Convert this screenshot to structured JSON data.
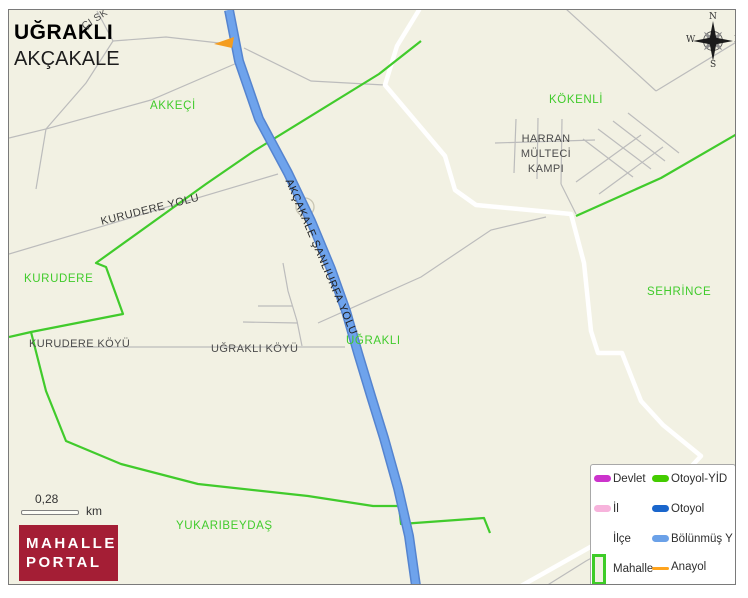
{
  "title": {
    "neighborhood": "UĞRAKLI",
    "district": "AKÇAKALE"
  },
  "map": {
    "region_labels": {
      "akkeci": "AKKEÇİ",
      "kokenli": "KÖKENLİ",
      "kurudere": "KURUDERE",
      "sehrince": "SEHRİNCE",
      "ugrakli": "UĞRAKLI",
      "yukaribeydas": "YUKARIBEYDAŞ"
    },
    "place_labels": {
      "harran_line1": "HARRAN",
      "harran_line2": "MÜLTECİ",
      "harran_line3": "KAMPI",
      "kurudere_koyu": "KURUDERE KÖYÜ",
      "ugrakli_koyu": "UĞRAKLI KÖYÜ"
    },
    "road_labels": {
      "kurudere_yolu": "KURUDERE YOLU",
      "akcakale_sanliurfa_yolu": "AKÇAKALE ŞANLIURFA YOLU",
      "sk": "ÇI SK"
    }
  },
  "compass": {
    "north": "N",
    "east": "E",
    "south": "S",
    "west": "W"
  },
  "scale_bar": {
    "distance": "0,28",
    "unit": "km"
  },
  "logo": {
    "line1": "MAHALLE",
    "line2": "PORTAL"
  },
  "legend": {
    "left": [
      {
        "label": "Devlet",
        "color": "#cc33cc"
      },
      {
        "label": "İl",
        "color": "#f7b3dc"
      },
      {
        "label": "İlçe",
        "color": "#ffffff"
      },
      {
        "label": "Mahalle",
        "color": "#3ecc28"
      }
    ],
    "right": [
      {
        "label": "Otoyol-YİD",
        "color": "#44cc00"
      },
      {
        "label": "Otoyol",
        "color": "#1a66cc"
      },
      {
        "label": "Bölünmüş Y",
        "color": "#6ba1e8"
      },
      {
        "label": "Anayol",
        "color": "#ffa41e"
      }
    ]
  },
  "colors": {
    "map_background": "#f2f1e3",
    "mahalle_boundary": "#41cb2c",
    "main_road": "#6ea3ec",
    "minor_road": "#bcbcbc",
    "ilce_boundary": "#ffffff",
    "logo_background": "#a41e35"
  }
}
